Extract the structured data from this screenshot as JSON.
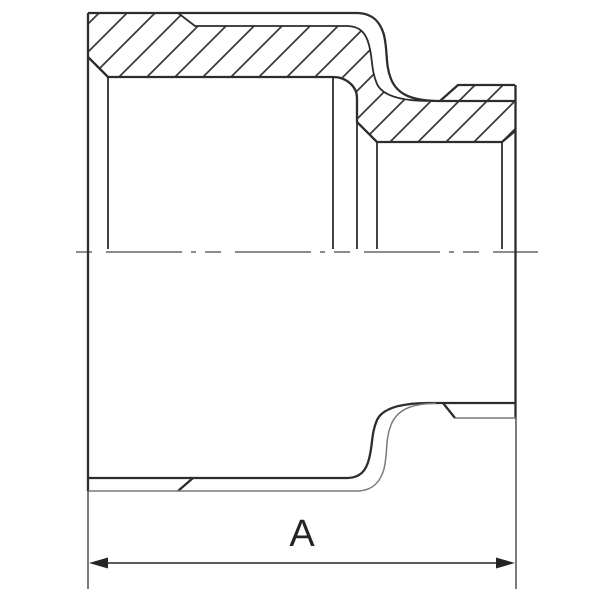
{
  "drawing": {
    "dimension_label": "A"
  },
  "style": {
    "background": "#ffffff",
    "line_color": "#2d2d2d",
    "secondary_line_color": "#7a7a7a",
    "hatch_color": "#383838",
    "centerline_color": "#474747",
    "dimension_color": "#242424"
  }
}
